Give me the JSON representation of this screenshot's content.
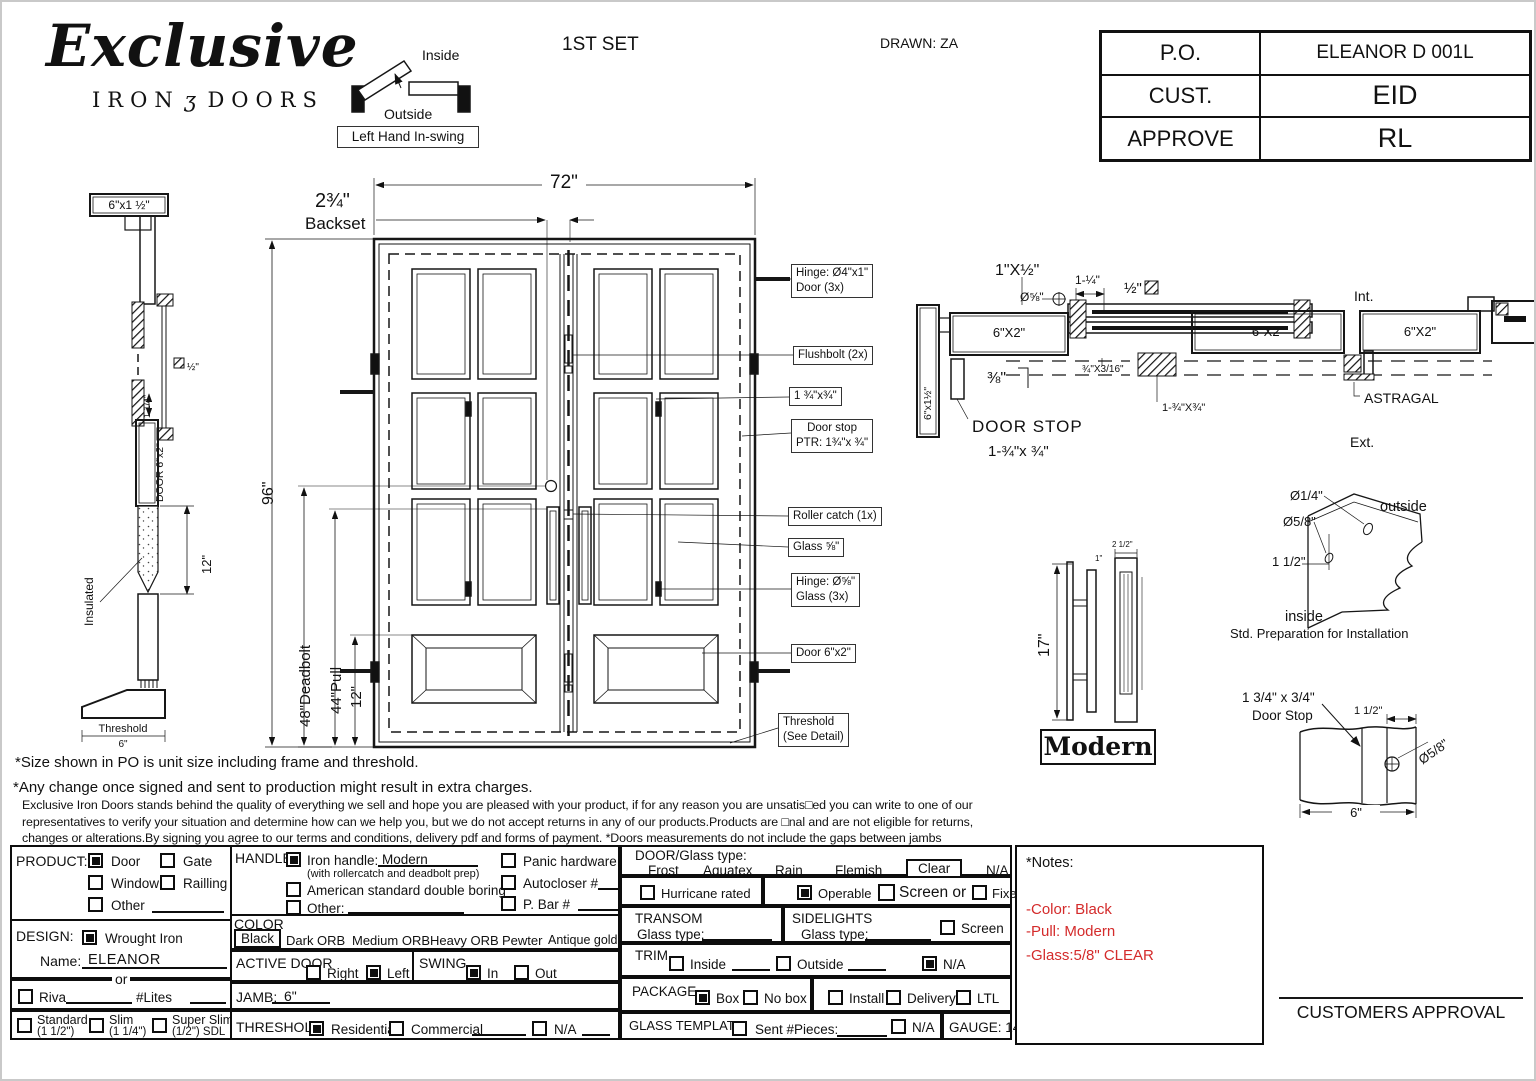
{
  "header": {
    "brand_script": "Exclusive",
    "brand_iron": "IRON",
    "brand_orn": "ʒ",
    "brand_doors": "DOORS",
    "set_label": "1ST SET",
    "drawn": "DRAWN: ZA",
    "swing_inside": "Inside",
    "swing_outside": "Outside",
    "swing_label": "Left Hand In-swing"
  },
  "po_table": {
    "rows": [
      {
        "k": "P.O.",
        "v": "ELEANOR D 001L"
      },
      {
        "k": "CUST.",
        "v": "EID"
      },
      {
        "k": "APPROVE",
        "v": "RL"
      }
    ]
  },
  "profile": {
    "top_label": "6\"x1 ½\"",
    "gap_label": "1 1/4\"",
    "half_label": "½\"",
    "door_label": "DOOR 6\"x2\"",
    "insulated": "Insulated",
    "dim12": "12\"",
    "threshold": "Threshold",
    "dim6": "6\""
  },
  "elevation": {
    "dim_width": "72\"",
    "backset_num": "2¾\"",
    "backset_word": "Backset",
    "dim_height": "96\"",
    "dim_deadbolt": "48\"Deadbolt",
    "dim_pull": "44\"Pull",
    "dim12": "12\"",
    "callouts": [
      {
        "l1": "Hinge: Ø4\"x1\"",
        "l2": "Door (3x)"
      },
      {
        "l1": "Flushbolt (2x)",
        "l2": ""
      },
      {
        "l1": "1 ¾\"x¾\"",
        "l2": ""
      },
      {
        "l1": "Door stop",
        "l2": "PTR: 1¾\"x ¾\""
      },
      {
        "l1": "Roller catch  (1x)",
        "l2": ""
      },
      {
        "l1": "Glass ⅝\"",
        "l2": ""
      },
      {
        "l1": "Hinge: Ø⅝\"",
        "l2": "Glass (3x)"
      },
      {
        "l1": "Door 6\"x2\"",
        "l2": ""
      },
      {
        "l1": "Threshold",
        "l2": "(See Detail)"
      }
    ]
  },
  "section": {
    "label_1xhalf": "1\"X½\"",
    "label_d58": "Ø⅝\"",
    "label_114": "1-¼\"",
    "label_half": "½\"",
    "head": "6\"X2\"",
    "jamb_v": "6\"x1½\"",
    "label_38": "⅜\"",
    "label_34x316": "¾\"X3/16\"",
    "label_134x34": "1-¾\"X¾\"",
    "doorstop1": "DOOR STOP",
    "doorstop2": "1-¾\"x ¾\"",
    "int": "Int.",
    "ext": "Ext.",
    "r1": "6\"X2\"",
    "r2": "6\"X2\"",
    "astragal": "ASTRAGAL"
  },
  "handle": {
    "dim17": "17\"",
    "dim1": "1\"",
    "dim25": "2 1/2\"",
    "name": "Modern"
  },
  "install": {
    "d14": "Ø1/4\"",
    "d58": "Ø5/8\"",
    "d112": "1 1/2\"",
    "outside": "outside",
    "inside": "inside",
    "caption": "Std. Preparation for Installation"
  },
  "stop_detail": {
    "t1": "1 3/4\" x 3/4\"",
    "t2": "Door Stop",
    "d112": "1 1/2\"",
    "d58": "Ø5/8\"",
    "d6": "6\""
  },
  "notes": {
    "line1": "*Size shown in PO is unit size including frame and threshold.",
    "line2": "*Any change once signed and sent to production might result in extra charges.",
    "para": "Exclusive Iron Doors stands behind the quality of everything we sell and hope you are pleased with your product, if for any reason you are unsatis□ed you can write to one of our representatives to verify your situation and determine how can we help you, but we do not accept returns in any of our products.Products are □nal and are not eligible for returns, changes or alterations.By signing you agree to our terms and conditions, delivery pdf and forms of payment. *Doors measurements do not include the gaps between jambs"
  },
  "form": {
    "product": {
      "title": "PRODUCT:",
      "o1": "Door",
      "o2": "Gate",
      "o3": "Window",
      "o4": "Railling",
      "o5": "Other",
      "checked": "Door"
    },
    "design": {
      "title": "DESIGN:",
      "w": "Wrought Iron",
      "name_l": "Name:",
      "name_v": "ELEANOR",
      "or": "or",
      "riva": "Riva",
      "lites": "#Lites",
      "std": "Standard",
      "std2": "(1 1/2\")",
      "slim": "Slim",
      "slim2": "(1 1/4\")",
      "ss": "Super Slim",
      "ss2": "(1/2\") SDL",
      "checked": "Wrought Iron"
    },
    "handle": {
      "title": "HANDLE",
      "iron": "Iron handle:",
      "iron_v": "Modern",
      "sub": "(with rollercatch and deadbolt prep)",
      "amer": "American standard double boring",
      "other": "Other:",
      "panic": "Panic hardware",
      "auto": "Autocloser #",
      "pbar": "P. Bar #",
      "checked": "Iron handle"
    },
    "color": {
      "title": "COLOR",
      "sel": "Black",
      "o1": "Dark ORB",
      "o2": "Medium ORB",
      "o3": "Heavy ORB",
      "o4": "Pewter",
      "o5": "Antique gold"
    },
    "active": {
      "title": "ACTIVE DOOR",
      "r": "Right",
      "l": "Left",
      "checked": "Left"
    },
    "swing": {
      "title": "SWING",
      "i": "In",
      "o": "Out",
      "checked": "In"
    },
    "jamb": {
      "title": "JAMB:",
      "v": "6\""
    },
    "thr": {
      "title": "THRESHOLD",
      "r": "Residential",
      "c": "Commercial",
      "n": "N/A",
      "checked": "Residential"
    },
    "glass": {
      "title": "DOOR/Glass type:",
      "o1": "Frost",
      "o2": "Aquatex",
      "o3": "Rain",
      "o4": "Flemish",
      "sel": "Clear",
      "na": "N/A"
    },
    "row2": {
      "hurr": "Hurricane rated",
      "oper": "Operable",
      "screen": "Screen or",
      "fixed": "Fixed",
      "checked": "Operable"
    },
    "transom": {
      "title": "TRANSOM",
      "g": "Glass type:"
    },
    "side": {
      "title": "SIDELIGHTS",
      "g": "Glass type:",
      "screen": "Screen"
    },
    "trim": {
      "title": "TRIM",
      "i": "Inside",
      "o": "Outside",
      "n": "N/A",
      "checked": "N/A"
    },
    "pkg": {
      "title": "PACKAGE",
      "box": "Box",
      "nobox": "No box",
      "inst": "Install",
      "del": "Delivery",
      "ltl": "LTL",
      "checked": "Box"
    },
    "gt": {
      "title": "GLASS TEMPLATE",
      "sent": "Sent #Pieces:",
      "na": "N/A"
    },
    "gauge": "GAUGE: 14"
  },
  "notes_box": {
    "title": "*Notes:",
    "l1": "-Color: Black",
    "l2": "-Pull: Modern",
    "l3": "-Glass:5/8\" CLEAR",
    "color": "#d42b2b"
  },
  "approval": "CUSTOMERS APPROVAL"
}
